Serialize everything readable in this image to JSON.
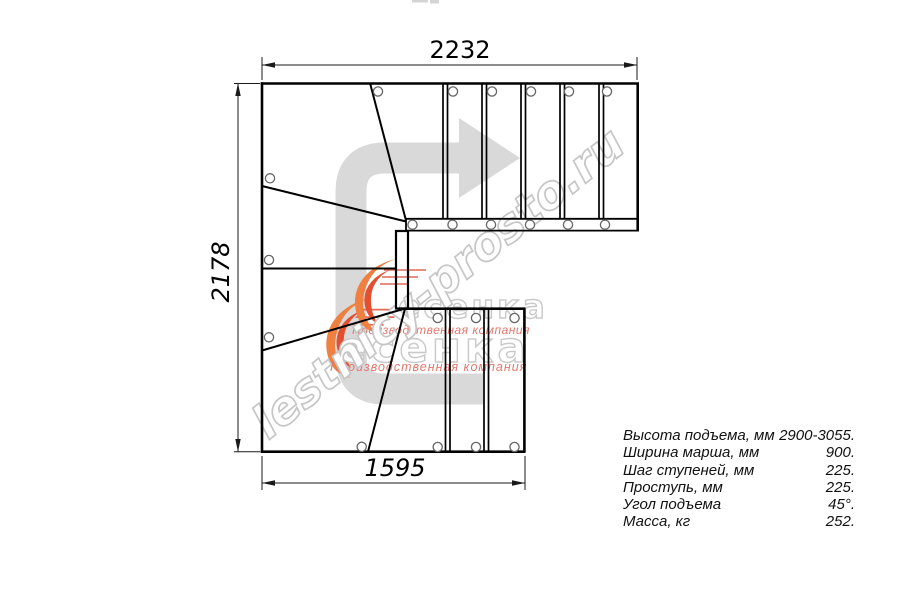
{
  "dimensions": {
    "top_mm": "2232",
    "left_mm": "2178",
    "bottom_mm": "1595"
  },
  "specs": {
    "rows": [
      {
        "label": "Высота подъема, мм",
        "value": "2900-3055."
      },
      {
        "label": "Ширина марша, мм",
        "value": "900."
      },
      {
        "label": "Шаг ступеней, мм",
        "value": "225."
      },
      {
        "label": "Проступь, мм",
        "value": "225."
      },
      {
        "label": "Угол подъема",
        "value": "45°."
      },
      {
        "label": "Масса, кг",
        "value": "252."
      }
    ]
  },
  "watermark": {
    "site": "lestnicy-prosto.ru",
    "brand": "есенка",
    "brand_caption": "Производственная компания",
    "colors": {
      "arrow_gray": "#d9d9d9",
      "outline_gray": "#c9c9c9",
      "caption_red": "#e2786e",
      "swoosh_orange": "#ef8040",
      "swoosh_red": "#e25030",
      "line_black": "#000000"
    }
  }
}
